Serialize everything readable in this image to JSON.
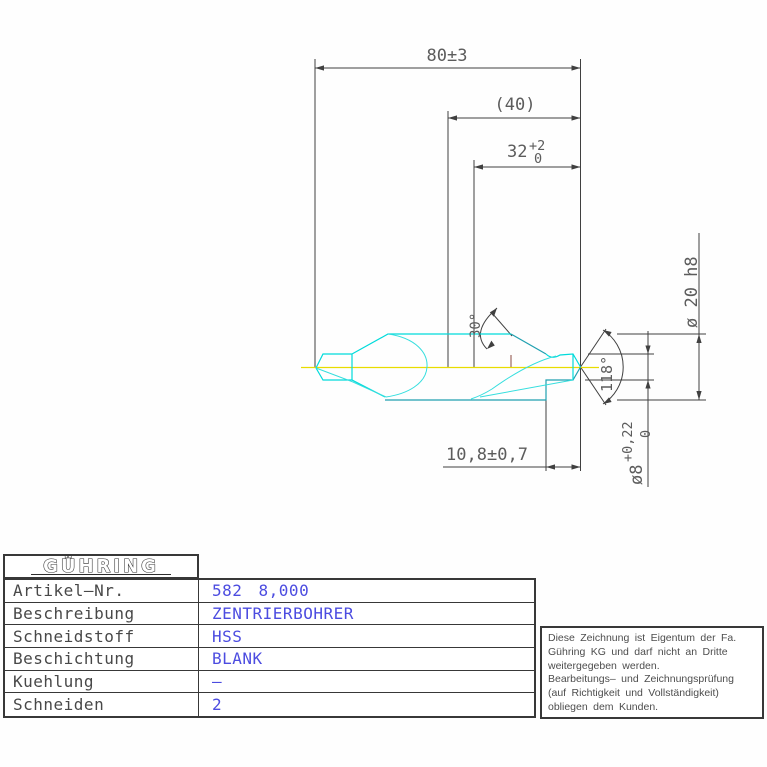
{
  "drawing": {
    "dimensions": {
      "overall_length": "80±3",
      "reference_length": "(40)",
      "step_length": {
        "main": "32",
        "tol_upper": "+2",
        "tol_lower": "0"
      },
      "pilot_length": "10,8±0,7",
      "shank_diameter": "ø 20 h8",
      "pilot_diameter": {
        "main": "ø8",
        "tol_upper": "+0,22",
        "tol_lower": "0"
      },
      "countersink_angle": "30°",
      "point_angle": "118°"
    },
    "colors": {
      "tool_outline": "#00dbdb",
      "centerline": "#e8dc00",
      "dimension_lines": "#404040",
      "value_text": "#4c4ce0"
    }
  },
  "title_block": {
    "logo": "GÜHRING",
    "rows": [
      {
        "label": "Artikel–Nr.",
        "value": "582 8,000"
      },
      {
        "label": "Beschreibung",
        "value": "ZENTRIERBOHRER"
      },
      {
        "label": "Schneidstoff",
        "value": "HSS"
      },
      {
        "label": "Beschichtung",
        "value": "BLANK"
      },
      {
        "label": "Kuehlung",
        "value": "–"
      },
      {
        "label": "Schneiden",
        "value": "2"
      }
    ]
  },
  "note_box": {
    "lines": [
      "Diese Zeichnung ist Eigentum der Fa.",
      "Gühring KG und darf nicht an Dritte",
      "weitergegeben werden.",
      "Bearbeitungs– und Zeichnungsprüfung",
      "(auf Richtigkeit und Vollständigkeit)",
      "obliegen dem Kunden."
    ]
  }
}
